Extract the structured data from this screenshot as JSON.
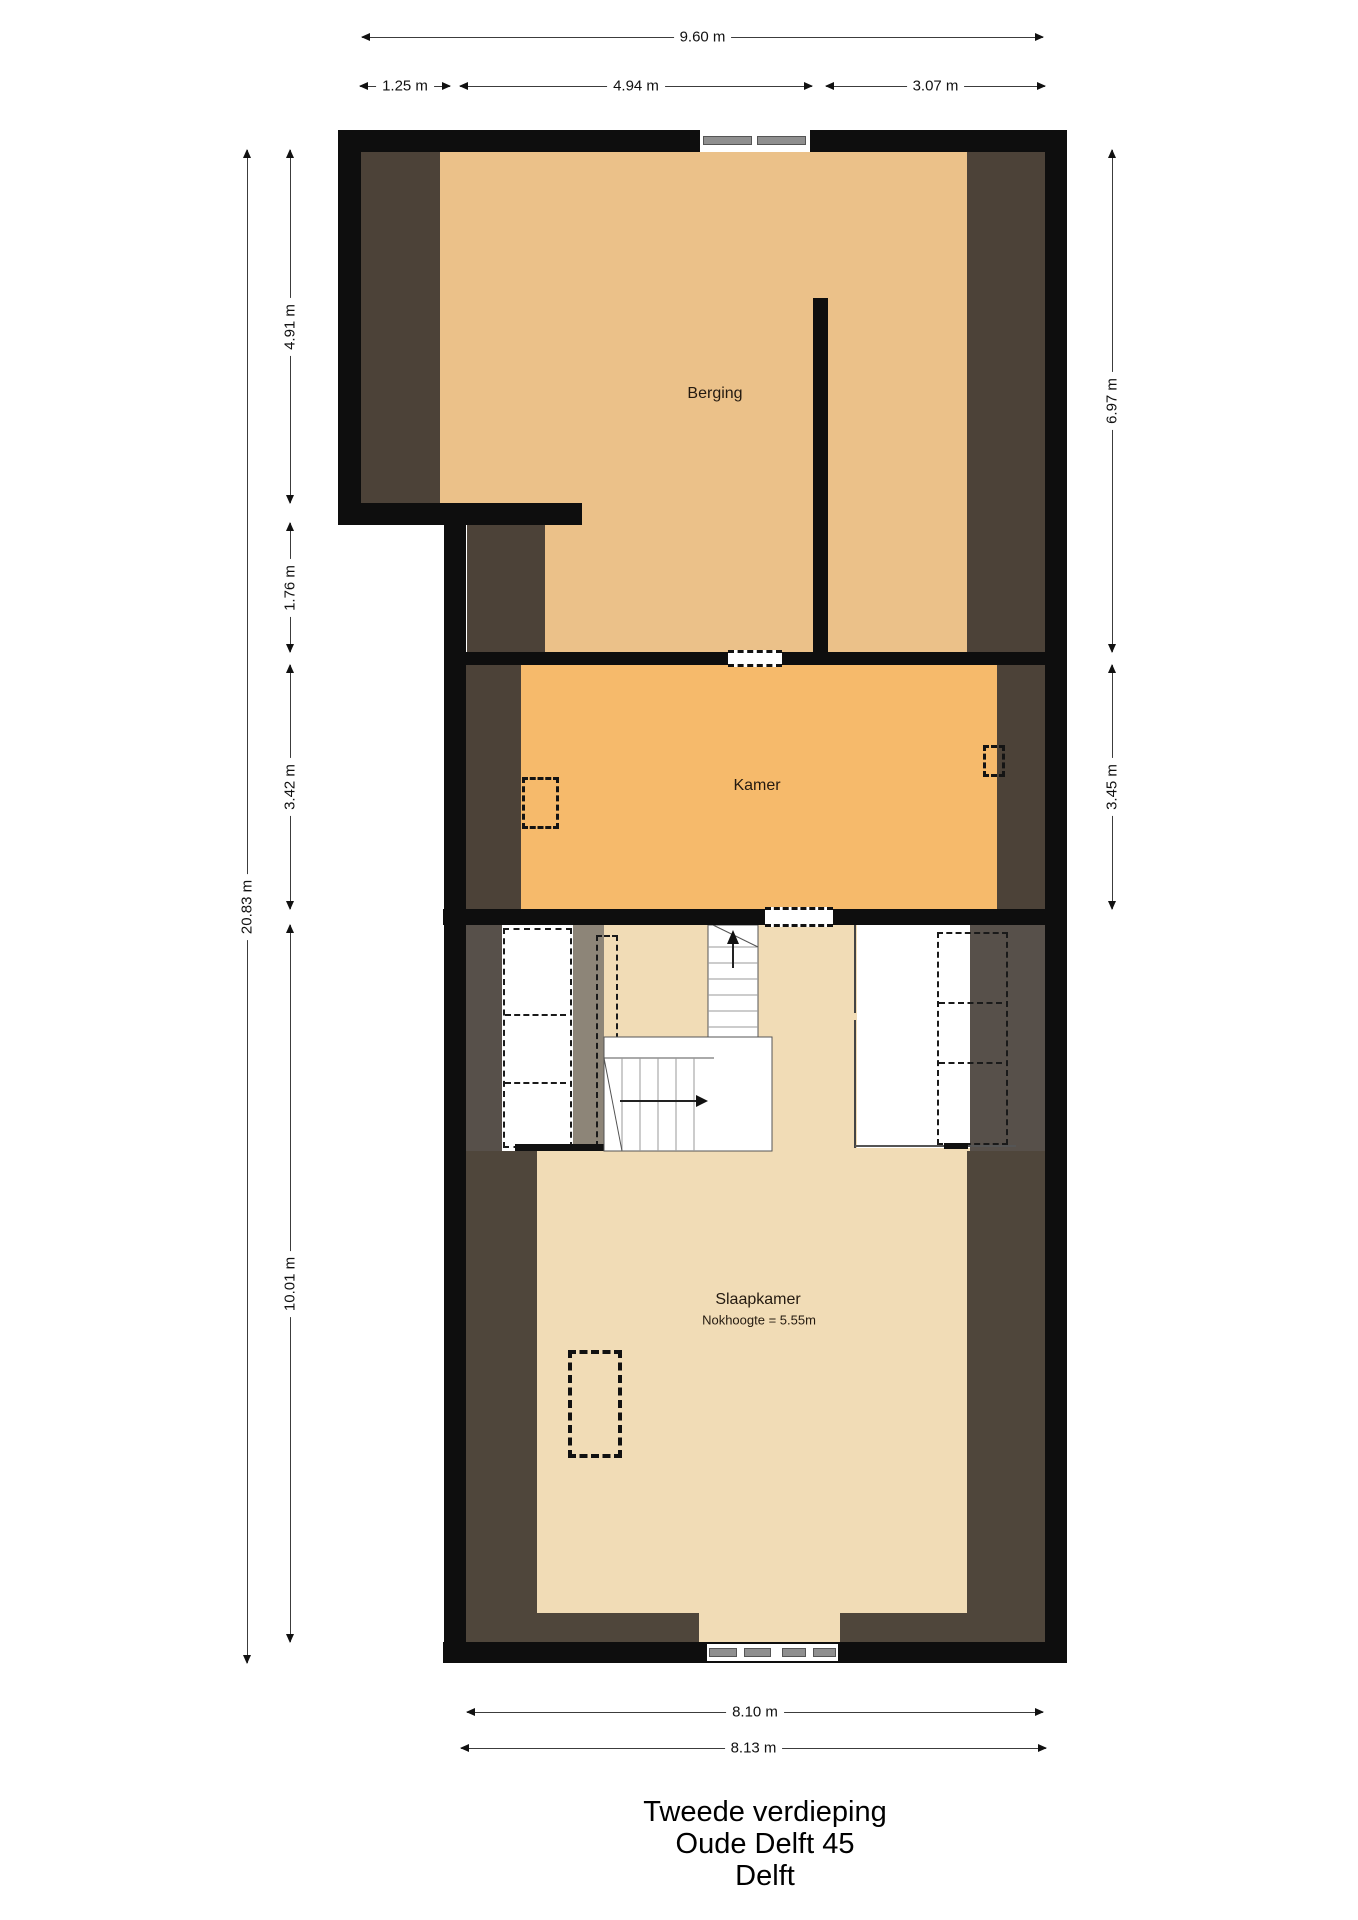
{
  "title": {
    "line1": "Tweede verdieping",
    "line2": "Oude Delft 45",
    "line3": "Delft"
  },
  "rooms": [
    {
      "name": "Berging"
    },
    {
      "name": "Kamer"
    },
    {
      "name": "Slaapkamer",
      "note": "Nokhoogte = 5.55m"
    }
  ],
  "dimensions": {
    "top": [
      {
        "label": "9.60 m"
      },
      {
        "label": "1.25 m"
      },
      {
        "label": "4.94 m"
      },
      {
        "label": "3.07 m"
      }
    ],
    "left": [
      {
        "label": "20.83 m"
      },
      {
        "label": "4.91 m"
      },
      {
        "label": "1.76 m"
      },
      {
        "label": "3.42 m"
      },
      {
        "label": "10.01 m"
      }
    ],
    "right": [
      {
        "label": "6.97 m"
      },
      {
        "label": "3.45 m"
      }
    ],
    "bottom": [
      {
        "label": "8.10 m"
      },
      {
        "label": "8.13 m"
      }
    ]
  },
  "colors": {
    "wall": "#0e0e0e",
    "berging": "#ebc189",
    "kamer": "#f6ba6b",
    "slaapkamer": "#f1dcb6",
    "roof_dark": "#4c4238",
    "roof_dark_band": "#57504a",
    "roof_dark_low": "#4f463b",
    "gray_floor": "#8d8578",
    "pane": "#8f8f8f",
    "dim_line": "#3c3c3c"
  }
}
